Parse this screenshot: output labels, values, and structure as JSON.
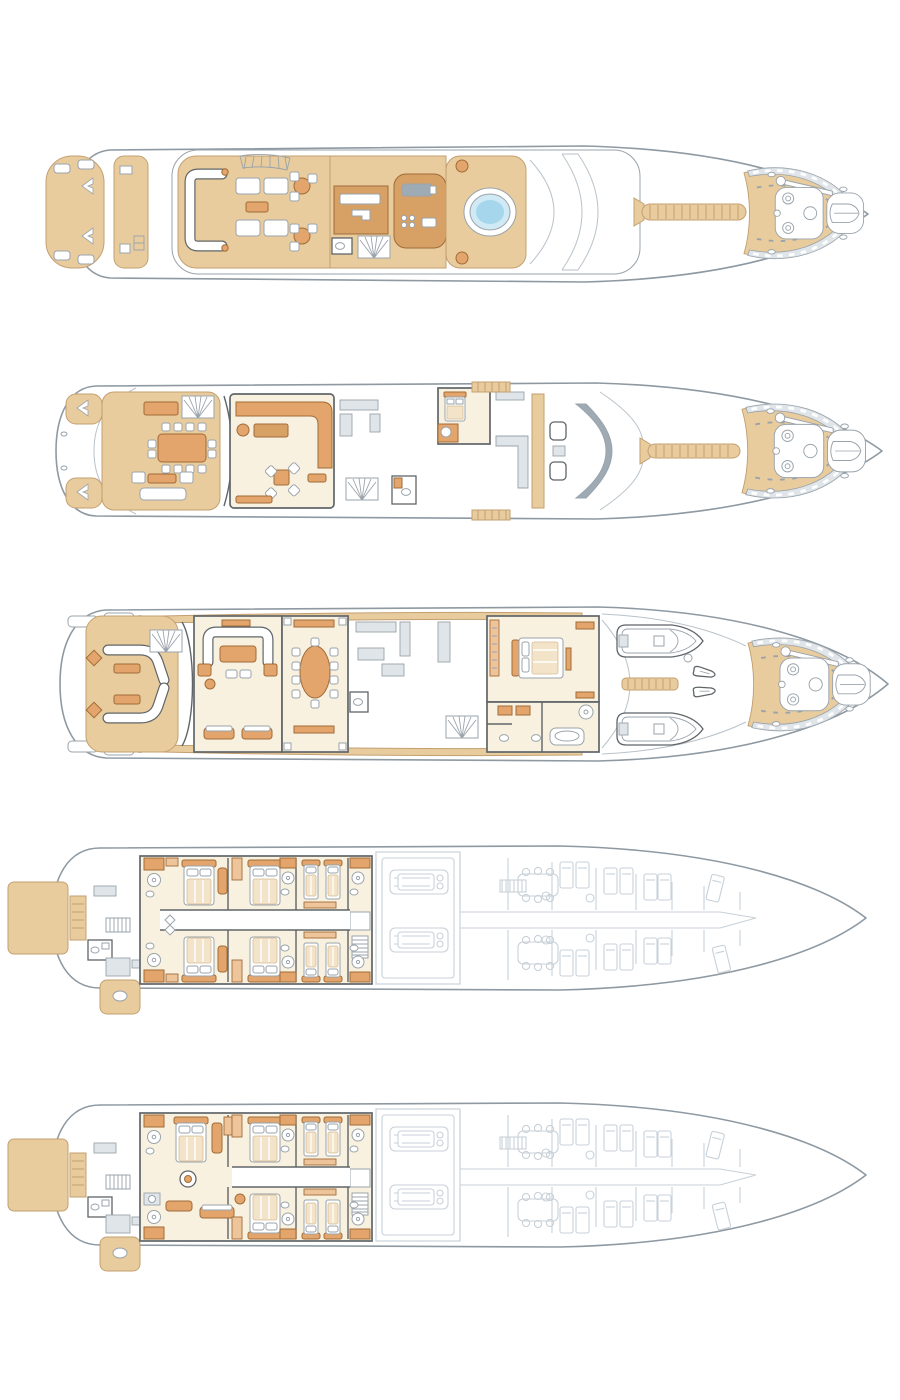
{
  "page": {
    "width": 900,
    "height": 1400,
    "background": "#ffffff",
    "title": "yacht-deck-plan-set",
    "deck_count": 5
  },
  "colors": {
    "bg": "#ffffff",
    "hull": "#8e99a2",
    "hull-light": "#b9c2c9",
    "wall": "#5f6569",
    "wall-light": "#9aa3ab",
    "teak": "#e9cc9d",
    "teak-edge": "#c3a071",
    "furn": "#e3a56b",
    "furn-edge": "#a06c39",
    "furn-light": "#eec49b",
    "tan-mid": "#d7a166",
    "cream": "#f9f1df",
    "faint": "#c8d1d8",
    "gray-deck": "#dfe5e9",
    "console": "#9fabb4",
    "pool": "#a5d6ec",
    "pool-ring": "#cfe9f5",
    "duvet": "#f2e3c9",
    "duvet-edge": "#d8bf96"
  },
  "decks": [
    {
      "name": "sun-deck",
      "order": 1,
      "features": [
        "aft-stair-pod",
        "sun-pads",
        "u-shaped-lounge",
        "awning",
        "cocktail-tables",
        "bar",
        "day-head",
        "fan-stairs",
        "gym-pod",
        "jacuzzi",
        "radar-arch",
        "mast-walkway",
        "foredeck-windlass",
        "tender-pocket"
      ]
    },
    {
      "name": "bridge-deck",
      "order": 2,
      "features": [
        "stern-stair-wings",
        "alfresco-dining-table-12-chairs",
        "bar-cabinet",
        "fan-stairs",
        "aft-sofa-group",
        "sky-lounge-corner-sofa",
        "card-table-4-chairs",
        "pantry",
        "day-head",
        "captain-cabin",
        "office",
        "wheelhouse-helm-chairs",
        "windshield",
        "mast-walkway",
        "foredeck-windlass"
      ]
    },
    {
      "name": "main-deck",
      "order": 3,
      "features": [
        "aft-curved-benches",
        "diamond-side-tables",
        "fan-stairs",
        "main-salon-u-sofa",
        "coffee-table",
        "armchairs",
        "aft-sofas",
        "formal-dining-oval-table-10-chairs",
        "sideboards",
        "galley",
        "lobby-stairs",
        "day-head",
        "owner-stateroom",
        "his-and-hers-bathroom",
        "tender-x2",
        "jet-ski-x2",
        "foredeck-windlass"
      ]
    },
    {
      "name": "lower-deck",
      "order": 4,
      "features": [
        "swim-platform",
        "beach-stairs",
        "transom-bathroom",
        "passerelle",
        "guest-double-cabin-x4",
        "guest-twin-cabin-x2",
        "ensuite-bathrooms",
        "corridor",
        "stair-lobby",
        "engine-room-x2-engines",
        "crew-mess",
        "crew-bunk-cabins",
        "unshaded-forward-area"
      ]
    },
    {
      "name": "lower-deck-b",
      "order": 5,
      "features": [
        "swim-platform",
        "beach-stairs",
        "transom-bathroom",
        "passerelle",
        "full-beam-suite-with-lounge",
        "round-ottoman",
        "guest-double-cabin-x2",
        "guest-twin-cabin-x2",
        "ensuite-bathrooms",
        "corridor",
        "stair-lobby",
        "engine-room-x2-engines",
        "crew-quarters",
        "unshaded-forward-area"
      ]
    }
  ]
}
